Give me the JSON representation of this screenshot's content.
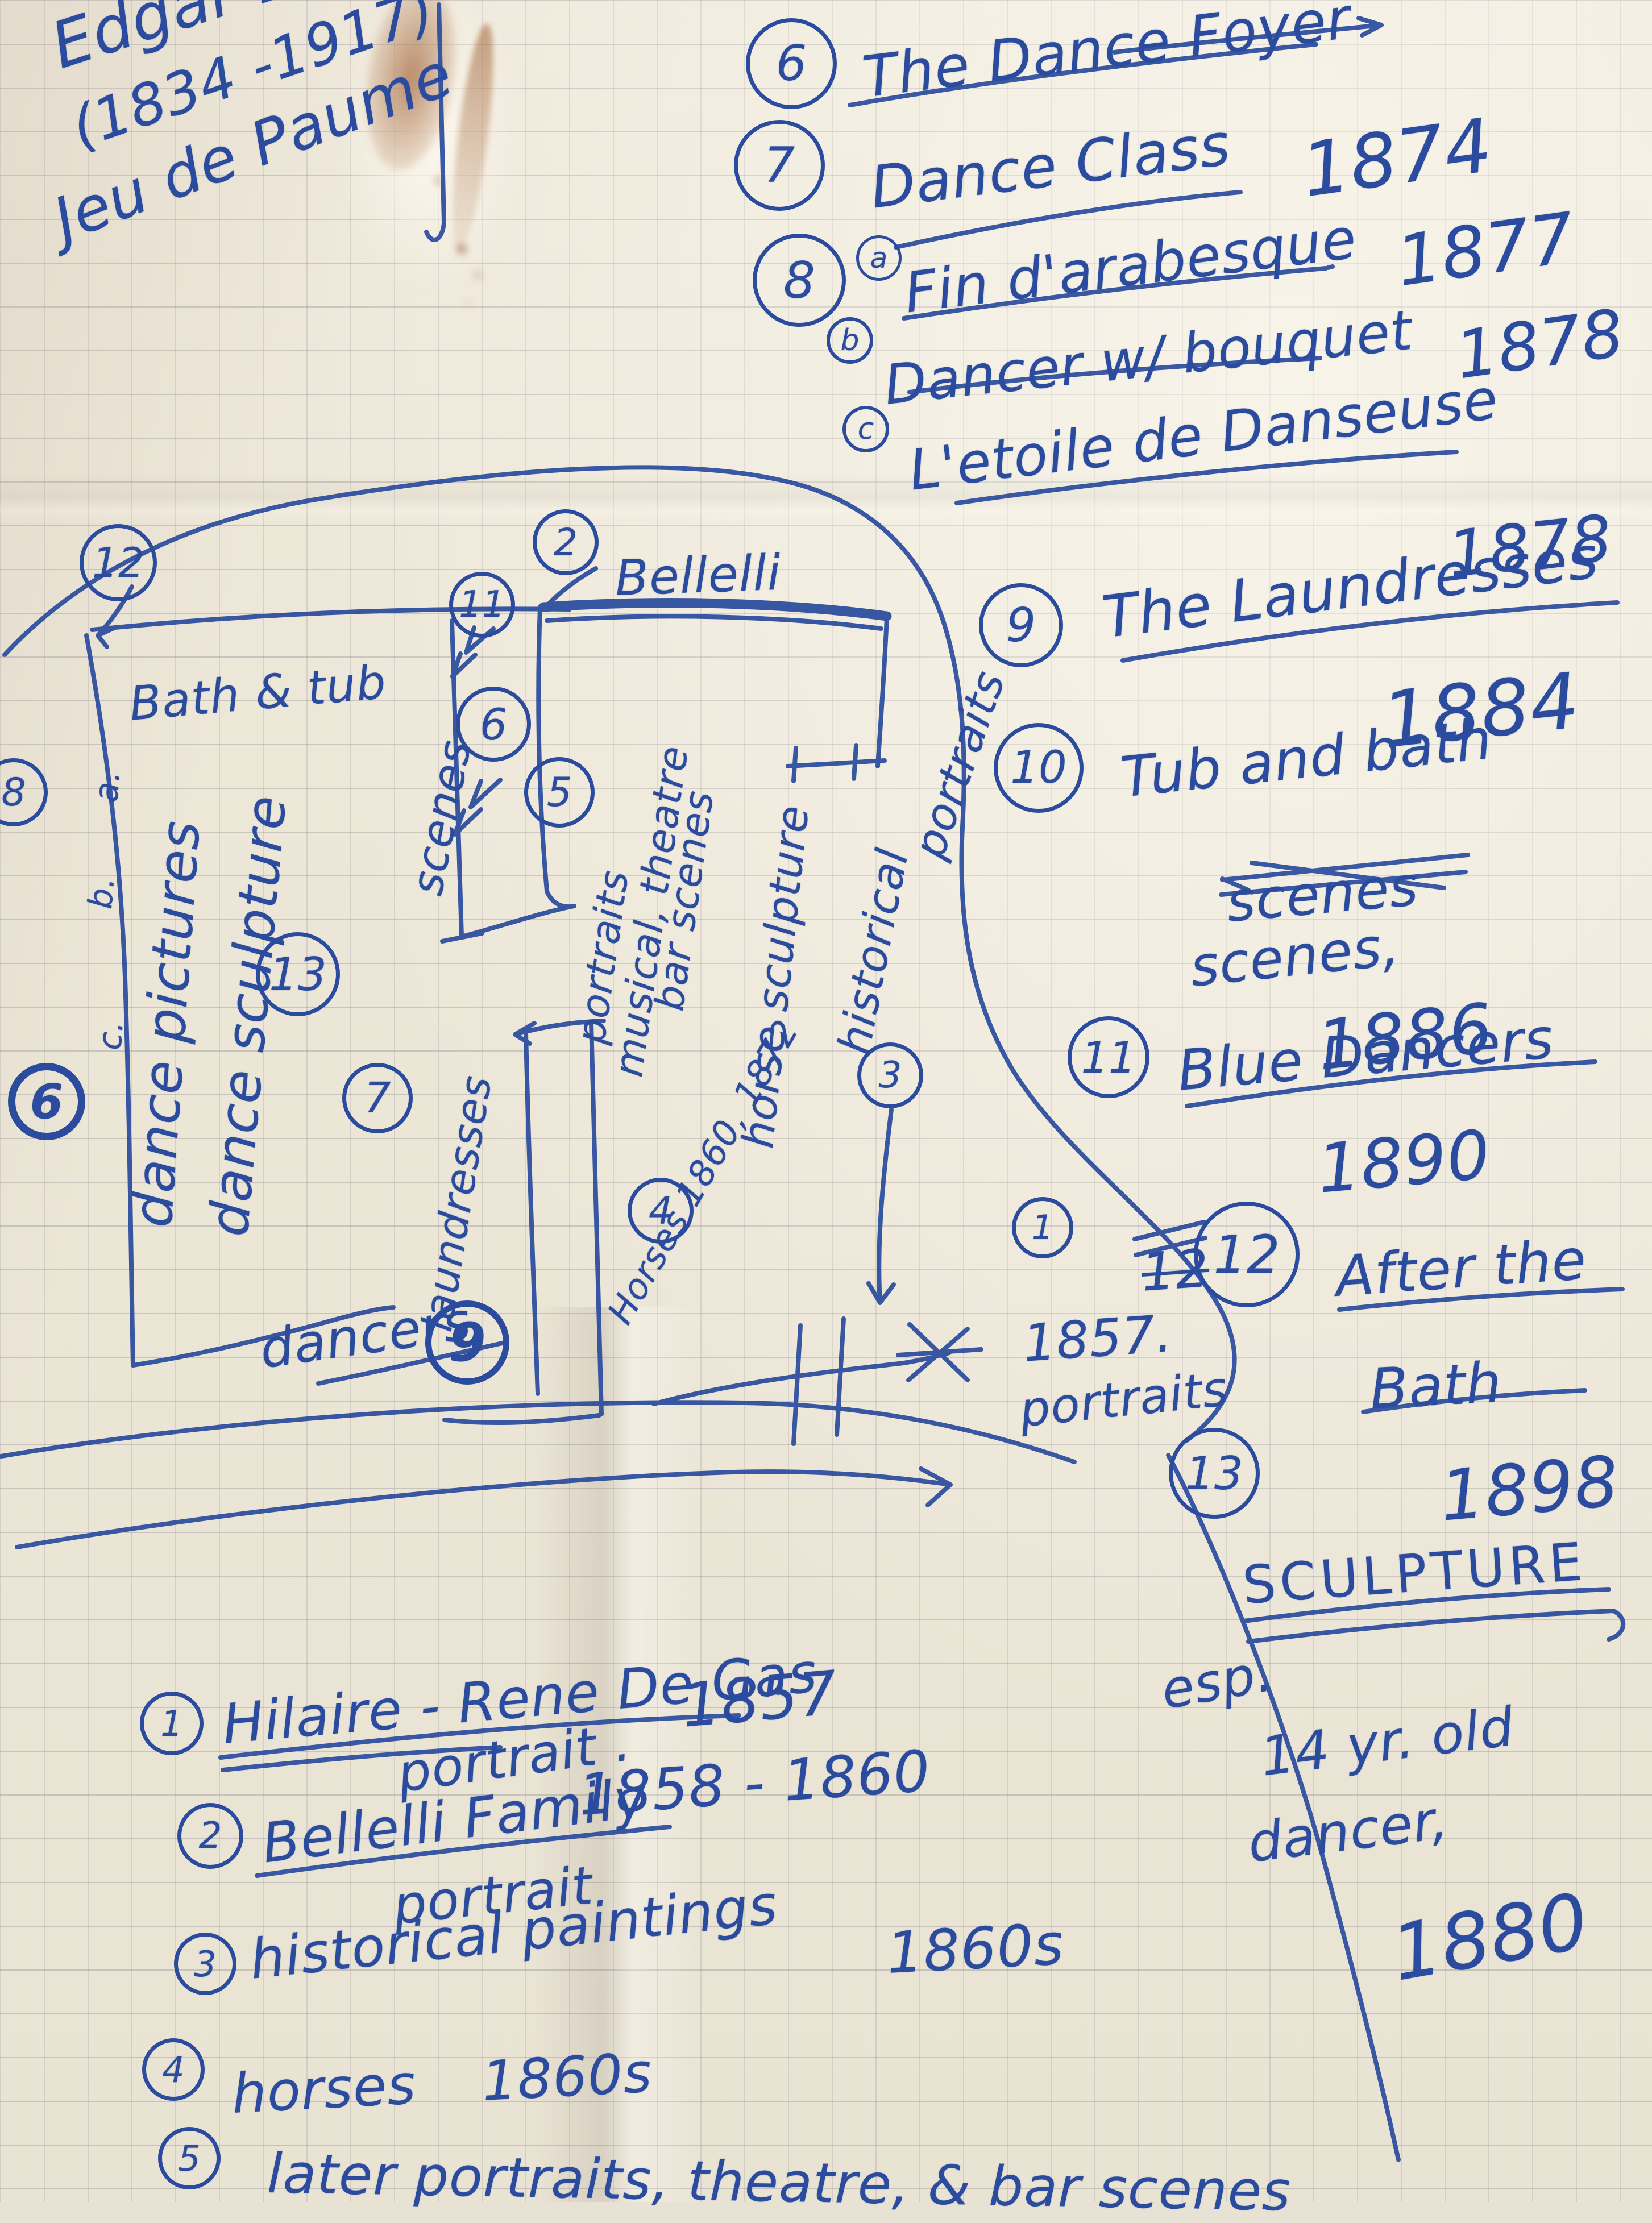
{
  "header": {
    "artist": "Edgar Degas",
    "dates": "(1834 -1917)",
    "venue": "Jeu de Paume"
  },
  "right_list": [
    {
      "num": "6",
      "title": "The Dance Foyer"
    },
    {
      "num": "7",
      "title": "Dance Class",
      "year": "1874"
    },
    {
      "num": "8",
      "marker": "a",
      "title": "Fin d'arabesque",
      "year": "1877"
    },
    {
      "marker": "b",
      "title": "Dancer w/ bouquet",
      "year": "1878"
    },
    {
      "marker": "c",
      "title": "L'etoile de Danseuse",
      "year": "1878"
    },
    {
      "num": "9",
      "title": "The Laundresses",
      "year": "1884"
    },
    {
      "num": "10",
      "title": "Tub and bath",
      "crossed_word": "scenes",
      "reword": "scenes,",
      "year": "1886"
    },
    {
      "num": "11",
      "title": "Blue Dancers",
      "year": "1890"
    },
    {
      "num": "12",
      "crossed_num": "12",
      "title": "After the",
      "title2": "Bath",
      "year": "1898"
    },
    {
      "num": "13",
      "title": "SCULPTURE",
      "note1": "esp.",
      "note2": "14 yr. old",
      "note3": "dancer,",
      "year": "1880"
    }
  ],
  "bottom_list": [
    {
      "num": "1",
      "title": "Hilaire - Rene De Gas",
      "year": "1857",
      "note": "portrait ."
    },
    {
      "num": "2",
      "title": "Bellelli Family",
      "year": "1858 - 1860",
      "note": "portrait"
    },
    {
      "num": "3",
      "title": "historical paintings",
      "year": "1860s"
    },
    {
      "num": "4",
      "title": "horses",
      "year": "1860s"
    },
    {
      "num": "5",
      "title": "later portraits, theatre, & bar scenes"
    }
  ],
  "map": {
    "n12": "12",
    "n11": "11",
    "n6_mid": "6",
    "n5": "5",
    "n2": "2",
    "n3": "3",
    "n13": "13",
    "n7": "7",
    "n9": "9",
    "n4": "4",
    "n8_left": "8",
    "n6_left": "6",
    "n1": "1",
    "bath_tub": "Bath & tub",
    "marker_a": "a.",
    "marker_b": "b.",
    "marker_c": "c.",
    "dance_pictures": "dance pictures",
    "dance_sculpture": "dance sculpture",
    "scenes": "scenes",
    "bellelli": "Bellelli",
    "portraits_col": "portraits",
    "musical_col": "musical, theatre",
    "bar_col": "bar scenes",
    "horse_sculpture": "horse sculpture",
    "historical": "historical",
    "portraits_edge": "portraits",
    "laundresses": "laundresses",
    "dancers": "dancers",
    "horses_years": "Horses 1860, 1872",
    "anno_1857": "1857.",
    "anno_portraits": "portraits"
  }
}
